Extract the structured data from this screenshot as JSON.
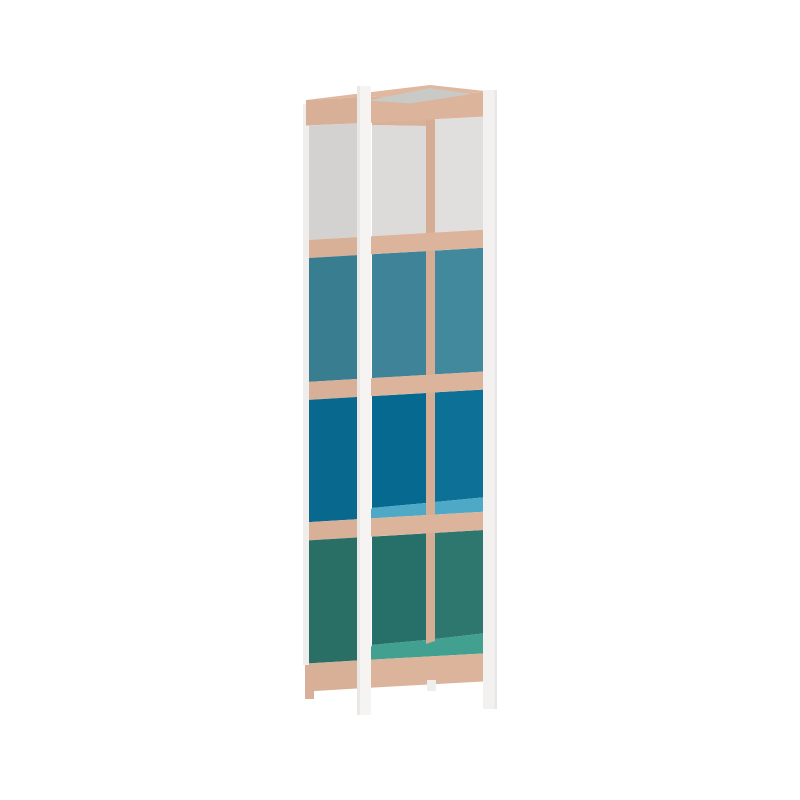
{
  "meta": {
    "kind": "product-render",
    "description": "3D render of a tall four-compartment shelving tower, front three-quarter view, plain white background, no text or UI controls visible",
    "canvas": {
      "width": 800,
      "height": 800
    },
    "background": "#ffffff"
  },
  "product": {
    "name": "four-tier shelving tower",
    "frame_material": "white posts",
    "shelf_material": "beech wood",
    "compartments": [
      {
        "index": 1,
        "color_name": "white-gray",
        "hex": "#dcdbd9"
      },
      {
        "index": 2,
        "color_name": "teal-blue",
        "hex": "#3e8397"
      },
      {
        "index": 3,
        "color_name": "ocean-blue",
        "hex": "#056990"
      },
      {
        "index": 4,
        "color_name": "pine-green",
        "hex": "#27706a"
      }
    ],
    "shelf_top_accents": [
      {
        "under": "ocean-blue compartment",
        "hex": "#4da9c6"
      },
      {
        "under": "pine-green compartment",
        "hex": "#41a08f"
      }
    ]
  },
  "colors": {
    "bg": "#ffffff",
    "woodTop": "#e0b79f",
    "woodInset": "#c9c9c6",
    "woodBandFront": "#dcb49c",
    "woodBandLeft": "#d7b097",
    "woodHeader": "#d9b199",
    "woodPost": "#d5ac94",
    "woodLeg": "#d8b099",
    "postWhite": "#f5f4f3",
    "postWhiteDim": "#efeeec",
    "postWhiteFar": "#f2f1f0",
    "postShade": "#e9e8e7",
    "legWhite": "#efeeed",
    "grayBack": "#dcdbd9",
    "grayRight": "#e0dfdd",
    "graySide": "#d3d2d1",
    "tealBack": "#3e8397",
    "tealRight": "#43899d",
    "tealSide": "#397d90",
    "blueBack": "#056990",
    "blueRight": "#0c7097",
    "blueSide": "#09688d",
    "greenBack": "#27706a",
    "greenRight": "#2e776f",
    "greenSide": "#296f66",
    "floorBlue": "#4da9c6",
    "floorGreen": "#41a08f"
  }
}
